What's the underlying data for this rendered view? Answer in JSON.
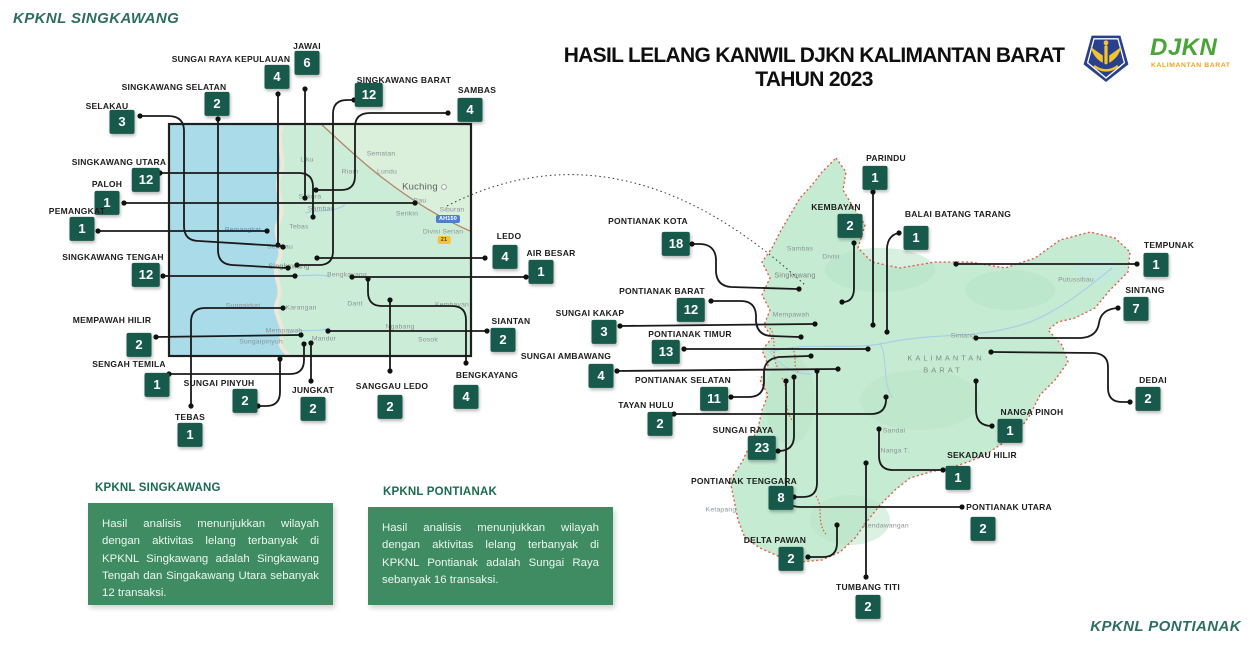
{
  "header": {
    "corner_top_left": "KPKNL SINGKAWANG",
    "corner_bottom_right": "KPKNL PONTIANAK",
    "title": "HASIL LELANG KANWIL DJKN KALIMANTAN BARAT TAHUN 2023",
    "logo": {
      "kemenkeu_icon": "kemenkeu-emblem",
      "djkn": "DJKN",
      "djkn_sub": "KALIMANTAN BARAT"
    }
  },
  "colors": {
    "badge": "#175a4b",
    "info_box": "#3f8c63",
    "info_title": "#1b6b4e",
    "corner_teal": "#2e6e62",
    "water": "#a9dbe9",
    "land_left": "#cbedd8",
    "land_right": "#c6ebd3",
    "border_red": "#e2543c",
    "connector": "#1a1a1a"
  },
  "info_boxes": [
    {
      "title": "KPKNL SINGKAWANG",
      "body": "Hasil analisis menunjukkan wilayah dengan aktivitas lelang terbanyak di KPKNL Singkawang adalah Singkawang Tengah dan Singakawang Utara sebanyak 12 transaksi."
    },
    {
      "title": "KPKNL PONTIANAK",
      "body": "Hasil analisis menunjukkan wilayah dengan aktivitas lelang terbanyak di KPKNL Pontianak adalah Sungai Raya sebanyak 16 transaksi."
    }
  ],
  "markers": [
    {
      "group": "singkawang",
      "label": "SUNGAI RAYA KEPULAUAN",
      "value": "4",
      "lx": 231,
      "ly": 59,
      "bx": 277,
      "by": 77,
      "sx": 278,
      "sy": 94,
      "ex": 278,
      "ey": 245,
      "path": "M278,94 L278,243"
    },
    {
      "group": "singkawang",
      "label": "JAWAI",
      "value": "6",
      "lx": 307,
      "ly": 46,
      "bx": 307,
      "by": 63,
      "sx": 305,
      "sy": 89,
      "ex": 305,
      "ey": 198,
      "path": "M305,89 L305,196"
    },
    {
      "group": "singkawang",
      "label": "SINGKAWANG SELATAN",
      "value": "2",
      "lx": 174,
      "ly": 87,
      "bx": 217,
      "by": 104,
      "sx": 218,
      "sy": 119,
      "ex": 288,
      "ey": 268,
      "path": "M218,119 L218,250 Q218,264 232,265 L286,268"
    },
    {
      "group": "singkawang",
      "label": "SELAKAU",
      "value": "3",
      "lx": 107,
      "ly": 106,
      "bx": 122,
      "by": 122,
      "sx": 140,
      "sy": 116,
      "ex": 283,
      "ey": 247,
      "path": "M140,116 L168,116 Q184,116 184,131 L184,226 Q184,241 199,241 L281,246"
    },
    {
      "group": "singkawang",
      "label": "SINGKAWANG BARAT",
      "value": "12",
      "lx": 404,
      "ly": 80,
      "bx": 369,
      "by": 95,
      "sx": 354,
      "sy": 100,
      "ex": 297,
      "ey": 265,
      "path": "M354,100 L347,100 Q333,100 333,114 L333,251 Q333,265 319,265 L299,265"
    },
    {
      "group": "singkawang",
      "label": "SAMBAS",
      "value": "4",
      "lx": 477,
      "ly": 90,
      "bx": 470,
      "by": 110,
      "sx": 448,
      "sy": 113,
      "ex": 316,
      "ey": 190,
      "path": "M448,113 L370,113 Q355,113 355,127 L355,176 Q355,190 341,190 L318,190"
    },
    {
      "group": "singkawang",
      "label": "SINGKAWANG UTARA",
      "value": "12",
      "lx": 119,
      "ly": 162,
      "bx": 146,
      "by": 180,
      "sx": 160,
      "sy": 173,
      "ex": 313,
      "ey": 217,
      "path": "M160,173 L299,173 Q313,173 313,187 L313,215"
    },
    {
      "group": "singkawang",
      "label": "PALOH",
      "value": "1",
      "lx": 107,
      "ly": 184,
      "bx": 107,
      "by": 203,
      "sx": 124,
      "sy": 203,
      "ex": 415,
      "ey": 203,
      "path": "M124,203 L413,203"
    },
    {
      "group": "singkawang",
      "label": "PEMANGKAT",
      "value": "1",
      "lx": 77,
      "ly": 211,
      "bx": 82,
      "by": 229,
      "sx": 98,
      "sy": 231,
      "ex": 267,
      "ey": 231,
      "path": "M98,231 L265,231"
    },
    {
      "group": "singkawang",
      "label": "SINGKAWANG TENGAH",
      "value": "12",
      "lx": 113,
      "ly": 257,
      "bx": 146,
      "by": 275,
      "sx": 163,
      "sy": 276,
      "ex": 295,
      "ey": 276,
      "path": "M163,276 L293,276"
    },
    {
      "group": "singkawang",
      "label": "MEMPAWAH HILIR",
      "value": "2",
      "lx": 112,
      "ly": 320,
      "bx": 139,
      "by": 345,
      "sx": 156,
      "sy": 337,
      "ex": 301,
      "ey": 335,
      "path": "M156,337 L299,335"
    },
    {
      "group": "singkawang",
      "label": "SENGAH TEMILA",
      "value": "1",
      "lx": 129,
      "ly": 364,
      "bx": 157,
      "by": 385,
      "sx": 169,
      "sy": 374,
      "ex": 304,
      "ey": 344,
      "path": "M169,374 L290,374 Q304,374 304,360 L304,346"
    },
    {
      "group": "singkawang",
      "label": "SUNGAI PINYUH",
      "value": "2",
      "lx": 219,
      "ly": 383,
      "bx": 245,
      "by": 401,
      "sx": 258,
      "sy": 406,
      "ex": 280,
      "ey": 359,
      "path": "M258,406 L266,406 Q280,406 280,392 L280,361"
    },
    {
      "group": "singkawang",
      "label": "JUNGKAT",
      "value": "2",
      "lx": 313,
      "ly": 390,
      "bx": 313,
      "by": 409,
      "sx": 311,
      "sy": 381,
      "ex": 311,
      "ey": 343,
      "path": "M311,381 L311,345"
    },
    {
      "group": "singkawang",
      "label": "TEBAS",
      "value": "1",
      "lx": 190,
      "ly": 417,
      "bx": 190,
      "by": 435,
      "sx": 191,
      "sy": 406,
      "ex": 283,
      "ey": 308,
      "path": "M191,406 L191,322 Q191,308 205,308 L281,308"
    },
    {
      "group": "singkawang",
      "label": "SANGGAU LEDO",
      "value": "2",
      "lx": 392,
      "ly": 386,
      "bx": 390,
      "by": 407,
      "sx": 390,
      "sy": 371,
      "ex": 390,
      "ey": 300,
      "path": "M390,371 L390,302"
    },
    {
      "group": "singkawang",
      "label": "BENGKAYANG",
      "value": "4",
      "lx": 487,
      "ly": 375,
      "bx": 466,
      "by": 397,
      "sx": 466,
      "sy": 363,
      "ex": 368,
      "ey": 279,
      "path": "M466,363 L466,320 Q466,306 452,306 L382,306 Q368,306 368,292 L368,281"
    },
    {
      "group": "singkawang",
      "label": "SIANTAN",
      "value": "2",
      "lx": 511,
      "ly": 321,
      "bx": 503,
      "by": 340,
      "sx": 487,
      "sy": 331,
      "ex": 328,
      "ey": 331,
      "path": "M487,331 L330,331"
    },
    {
      "group": "singkawang",
      "label": "LEDO",
      "value": "4",
      "lx": 509,
      "ly": 236,
      "bx": 505,
      "by": 257,
      "sx": 485,
      "sy": 258,
      "ex": 317,
      "ey": 258,
      "path": "M485,258 L319,258"
    },
    {
      "group": "singkawang",
      "label": "AIR BESAR",
      "value": "1",
      "lx": 551,
      "ly": 253,
      "bx": 541,
      "by": 272,
      "sx": 526,
      "sy": 277,
      "ex": 352,
      "ey": 277,
      "path": "M526,277 L354,277"
    },
    {
      "group": "pontianak",
      "label": "PARINDU",
      "value": "1",
      "lx": 886,
      "ly": 158,
      "bx": 875,
      "by": 178,
      "sx": 873,
      "sy": 192,
      "ex": 873,
      "ey": 325,
      "path": "M873,192 L873,323"
    },
    {
      "group": "pontianak",
      "label": "KEMBAYAN",
      "value": "2",
      "lx": 836,
      "ly": 207,
      "bx": 850,
      "by": 226,
      "sx": 854,
      "sy": 243,
      "ex": 842,
      "ey": 302,
      "path": "M854,243 L854,288 Q854,301 844,302"
    },
    {
      "group": "pontianak",
      "label": "BALAI BATANG TARANG",
      "value": "1",
      "lx": 958,
      "ly": 214,
      "bx": 916,
      "by": 238,
      "sx": 899,
      "sy": 233,
      "ex": 887,
      "ey": 332,
      "path": "M899,233 Q888,235 887,248 L887,330"
    },
    {
      "group": "pontianak",
      "label": "PONTIANAK KOTA",
      "value": "18",
      "lx": 648,
      "ly": 221,
      "bx": 676,
      "by": 244,
      "sx": 692,
      "sy": 244,
      "ex": 799,
      "ey": 289,
      "path": "M692,244 L701,244 Q715,245 716,259 L716,272 Q717,286 731,287 L797,289"
    },
    {
      "group": "pontianak",
      "label": "PONTIANAK BARAT",
      "value": "12",
      "lx": 662,
      "ly": 291,
      "bx": 691,
      "by": 310,
      "sx": 711,
      "sy": 301,
      "ex": 801,
      "ey": 337,
      "path": "M711,301 L741,301 Q755,301 756,315 L756,321 Q757,335 771,336 L799,337"
    },
    {
      "group": "pontianak",
      "label": "SUNGAI KAKAP",
      "value": "3",
      "lx": 590,
      "ly": 313,
      "bx": 604,
      "by": 332,
      "sx": 620,
      "sy": 326,
      "ex": 815,
      "ey": 324,
      "path": "M620,326 L813,324"
    },
    {
      "group": "pontianak",
      "label": "PONTIANAK TIMUR",
      "value": "13",
      "lx": 690,
      "ly": 334,
      "bx": 666,
      "by": 352,
      "sx": 684,
      "sy": 349,
      "ex": 868,
      "ey": 349,
      "path": "M684,349 L866,349"
    },
    {
      "group": "pontianak",
      "label": "SUNGAI AMBAWANG",
      "value": "4",
      "lx": 566,
      "ly": 356,
      "bx": 601,
      "by": 376,
      "sx": 617,
      "sy": 371,
      "ex": 838,
      "ey": 369,
      "path": "M617,371 L836,369"
    },
    {
      "group": "pontianak",
      "label": "PONTIANAK SELATAN",
      "value": "11",
      "lx": 683,
      "ly": 380,
      "bx": 714,
      "by": 399,
      "sx": 731,
      "sy": 397,
      "ex": 811,
      "ey": 356,
      "path": "M731,397 L749,397 Q763,397 764,383 L764,371 Q765,359 779,357 L809,356"
    },
    {
      "group": "pontianak",
      "label": "TAYAN HULU",
      "value": "2",
      "lx": 646,
      "ly": 405,
      "bx": 660,
      "by": 424,
      "sx": 674,
      "sy": 414,
      "ex": 886,
      "ey": 397,
      "path": "M674,414 L871,414 Q885,414 886,401 L886,399"
    },
    {
      "group": "pontianak",
      "label": "SUNGAI RAYA",
      "value": "23",
      "lx": 743,
      "ly": 430,
      "bx": 762,
      "by": 448,
      "sx": 778,
      "sy": 451,
      "ex": 794,
      "ey": 377,
      "path": "M778,451 L780,451 Q794,450 794,436 L794,379"
    },
    {
      "group": "pontianak",
      "label": "PONTIANAK TENGGARA",
      "value": "8",
      "lx": 744,
      "ly": 481,
      "bx": 781,
      "by": 498,
      "sx": 794,
      "sy": 497,
      "ex": 817,
      "ey": 371,
      "path": "M794,497 L803,497 Q817,497 817,483 L817,373"
    },
    {
      "group": "pontianak",
      "label": "DELTA PAWAN",
      "value": "2",
      "lx": 775,
      "ly": 540,
      "bx": 791,
      "by": 559,
      "sx": 808,
      "sy": 557,
      "ex": 837,
      "ey": 525,
      "path": "M808,557 L823,557 Q837,557 837,543 L837,527"
    },
    {
      "group": "pontianak",
      "label": "TUMBANG TITI",
      "value": "2",
      "lx": 868,
      "ly": 587,
      "bx": 868,
      "by": 607,
      "sx": 866,
      "sy": 577,
      "ex": 866,
      "ey": 463,
      "path": "M866,577 L866,465"
    },
    {
      "group": "pontianak",
      "label": "PONTIANAK UTARA",
      "value": "2",
      "lx": 1009,
      "ly": 507,
      "bx": 983,
      "by": 529,
      "sx": 962,
      "sy": 507,
      "ex": 786,
      "ey": 381,
      "path": "M962,507 L800,507 Q786,507 786,493 L786,383"
    },
    {
      "group": "pontianak",
      "label": "SEKADAU HILIR",
      "value": "1",
      "lx": 982,
      "ly": 455,
      "bx": 958,
      "by": 478,
      "sx": 943,
      "sy": 470,
      "ex": 879,
      "ey": 429,
      "path": "M943,470 L893,470 Q879,470 879,456 L879,431"
    },
    {
      "group": "pontianak",
      "label": "NANGA PINOH",
      "value": "1",
      "lx": 1032,
      "ly": 412,
      "bx": 1010,
      "by": 431,
      "sx": 992,
      "sy": 426,
      "ex": 976,
      "ey": 381,
      "path": "M992,426 Q976,426 976,410 L976,383"
    },
    {
      "group": "pontianak",
      "label": "DEDAI",
      "value": "2",
      "lx": 1153,
      "ly": 380,
      "bx": 1148,
      "by": 399,
      "sx": 1130,
      "sy": 402,
      "ex": 991,
      "ey": 352,
      "path": "M1130,402 L1122,402 Q1108,402 1108,388 L1108,367 Q1108,354 1094,353 L993,352"
    },
    {
      "group": "pontianak",
      "label": "SINTANG",
      "value": "7",
      "lx": 1145,
      "ly": 290,
      "bx": 1136,
      "by": 309,
      "sx": 1118,
      "sy": 308,
      "ex": 976,
      "ey": 338,
      "path": "M1118,308 Q1101,309 1099,323 Q1097,337 1081,338 L978,338"
    },
    {
      "group": "pontianak",
      "label": "TEMPUNAK",
      "value": "1",
      "lx": 1169,
      "ly": 245,
      "bx": 1156,
      "by": 265,
      "sx": 1137,
      "sy": 264,
      "ex": 956,
      "ey": 264,
      "path": "M1137,264 L958,264"
    }
  ],
  "map_places": [
    {
      "text": "Liku",
      "x": 307,
      "y": 160,
      "cls": ""
    },
    {
      "text": "Sematan",
      "x": 381,
      "y": 154,
      "cls": ""
    },
    {
      "text": "Lundu",
      "x": 387,
      "y": 172,
      "cls": ""
    },
    {
      "text": "Riam",
      "x": 350,
      "y": 172,
      "cls": ""
    },
    {
      "text": "Kuching",
      "x": 420,
      "y": 187,
      "cls": "city"
    },
    {
      "text": "Bau",
      "x": 420,
      "y": 201,
      "cls": ""
    },
    {
      "text": "Siburan",
      "x": 452,
      "y": 210,
      "cls": ""
    },
    {
      "text": "Serikin",
      "x": 407,
      "y": 214,
      "cls": ""
    },
    {
      "text": "AH150",
      "x": 448,
      "y": 219,
      "cls": "road-blue"
    },
    {
      "text": "Divisi Serian",
      "x": 443,
      "y": 232,
      "cls": ""
    },
    {
      "text": "21",
      "x": 444,
      "y": 240,
      "cls": "road-yellow"
    },
    {
      "text": "Sekura",
      "x": 310,
      "y": 197,
      "cls": ""
    },
    {
      "text": "Sambas",
      "x": 321,
      "y": 209,
      "cls": ""
    },
    {
      "text": "Tebas",
      "x": 299,
      "y": 227,
      "cls": ""
    },
    {
      "text": "Pemangkat",
      "x": 243,
      "y": 230,
      "cls": "hl"
    },
    {
      "text": "Selakau",
      "x": 280,
      "y": 247,
      "cls": ""
    },
    {
      "text": "Singkawang",
      "x": 289,
      "y": 266,
      "cls": "city2"
    },
    {
      "text": "Bengkayang",
      "x": 347,
      "y": 275,
      "cls": ""
    },
    {
      "text": "Sungaiduri",
      "x": 243,
      "y": 306,
      "cls": ""
    },
    {
      "text": "Karangan",
      "x": 301,
      "y": 308,
      "cls": ""
    },
    {
      "text": "Darit",
      "x": 355,
      "y": 304,
      "cls": ""
    },
    {
      "text": "Kembayan",
      "x": 452,
      "y": 305,
      "cls": ""
    },
    {
      "text": "Ngabang",
      "x": 400,
      "y": 327,
      "cls": ""
    },
    {
      "text": "Sosok",
      "x": 428,
      "y": 340,
      "cls": ""
    },
    {
      "text": "Mempawah",
      "x": 284,
      "y": 331,
      "cls": ""
    },
    {
      "text": "Mandor",
      "x": 324,
      "y": 339,
      "cls": ""
    },
    {
      "text": "Sungaipinyuh",
      "x": 261,
      "y": 342,
      "cls": ""
    },
    {
      "text": "Sambas",
      "x": 800,
      "y": 249,
      "cls": ""
    },
    {
      "text": "Divisi",
      "x": 831,
      "y": 257,
      "cls": ""
    },
    {
      "text": "Singkawang",
      "x": 795,
      "y": 275,
      "cls": "city2"
    },
    {
      "text": "Mempawah",
      "x": 791,
      "y": 315,
      "cls": ""
    },
    {
      "text": "Sintang",
      "x": 963,
      "y": 336,
      "cls": ""
    },
    {
      "text": "Putussibau",
      "x": 1076,
      "y": 280,
      "cls": ""
    },
    {
      "text": "KALIMANTAN",
      "x": 946,
      "y": 358,
      "cls": "region"
    },
    {
      "text": "BARAT",
      "x": 943,
      "y": 370,
      "cls": "region"
    },
    {
      "text": "Sandai",
      "x": 894,
      "y": 431,
      "cls": ""
    },
    {
      "text": "Nanga T.",
      "x": 895,
      "y": 451,
      "cls": ""
    },
    {
      "text": "Ketapang",
      "x": 721,
      "y": 510,
      "cls": ""
    },
    {
      "text": "Kendawangan",
      "x": 886,
      "y": 526,
      "cls": ""
    }
  ]
}
